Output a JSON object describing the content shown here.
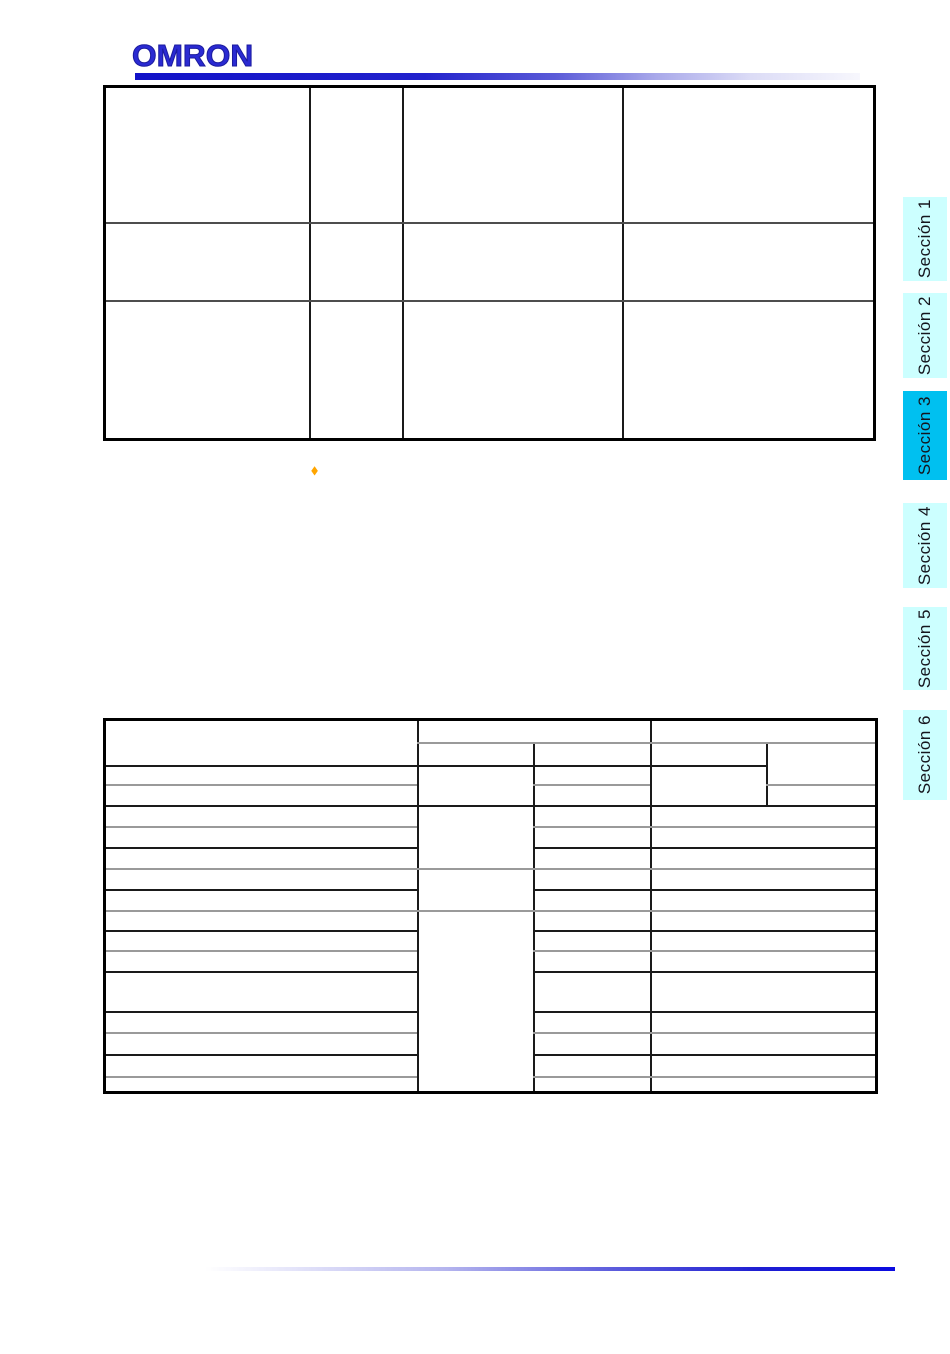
{
  "logo": {
    "text": "OMRON",
    "color": "#2a2ad2"
  },
  "decorations": {
    "top_rule_gradient": {
      "left": "#1212c8",
      "right": "#ffffff"
    },
    "bottom_rule_gradient": {
      "left": "#ffffff",
      "right": "#0b0be0"
    },
    "bullet": {
      "glyph": "◆",
      "color": "#ffa500"
    }
  },
  "section_tabs": {
    "active_bg": "#00c0f0",
    "inactive_bg": "#ccffff",
    "active_index": 2,
    "items": [
      {
        "label": "Sección 1",
        "active": false
      },
      {
        "label": "Sección 2",
        "active": false
      },
      {
        "label": "Sección 3",
        "active": true
      },
      {
        "label": "Sección 4",
        "active": false
      },
      {
        "label": "Sección 5",
        "active": false
      },
      {
        "label": "Sección 6",
        "active": false
      }
    ]
  },
  "tables": {
    "top_table": {
      "columns": 4,
      "rows": 3,
      "cells_text": []
    },
    "bottom_table": {
      "columns": 5,
      "body_rows": 15,
      "header_rows": 2,
      "cells_text": []
    }
  }
}
